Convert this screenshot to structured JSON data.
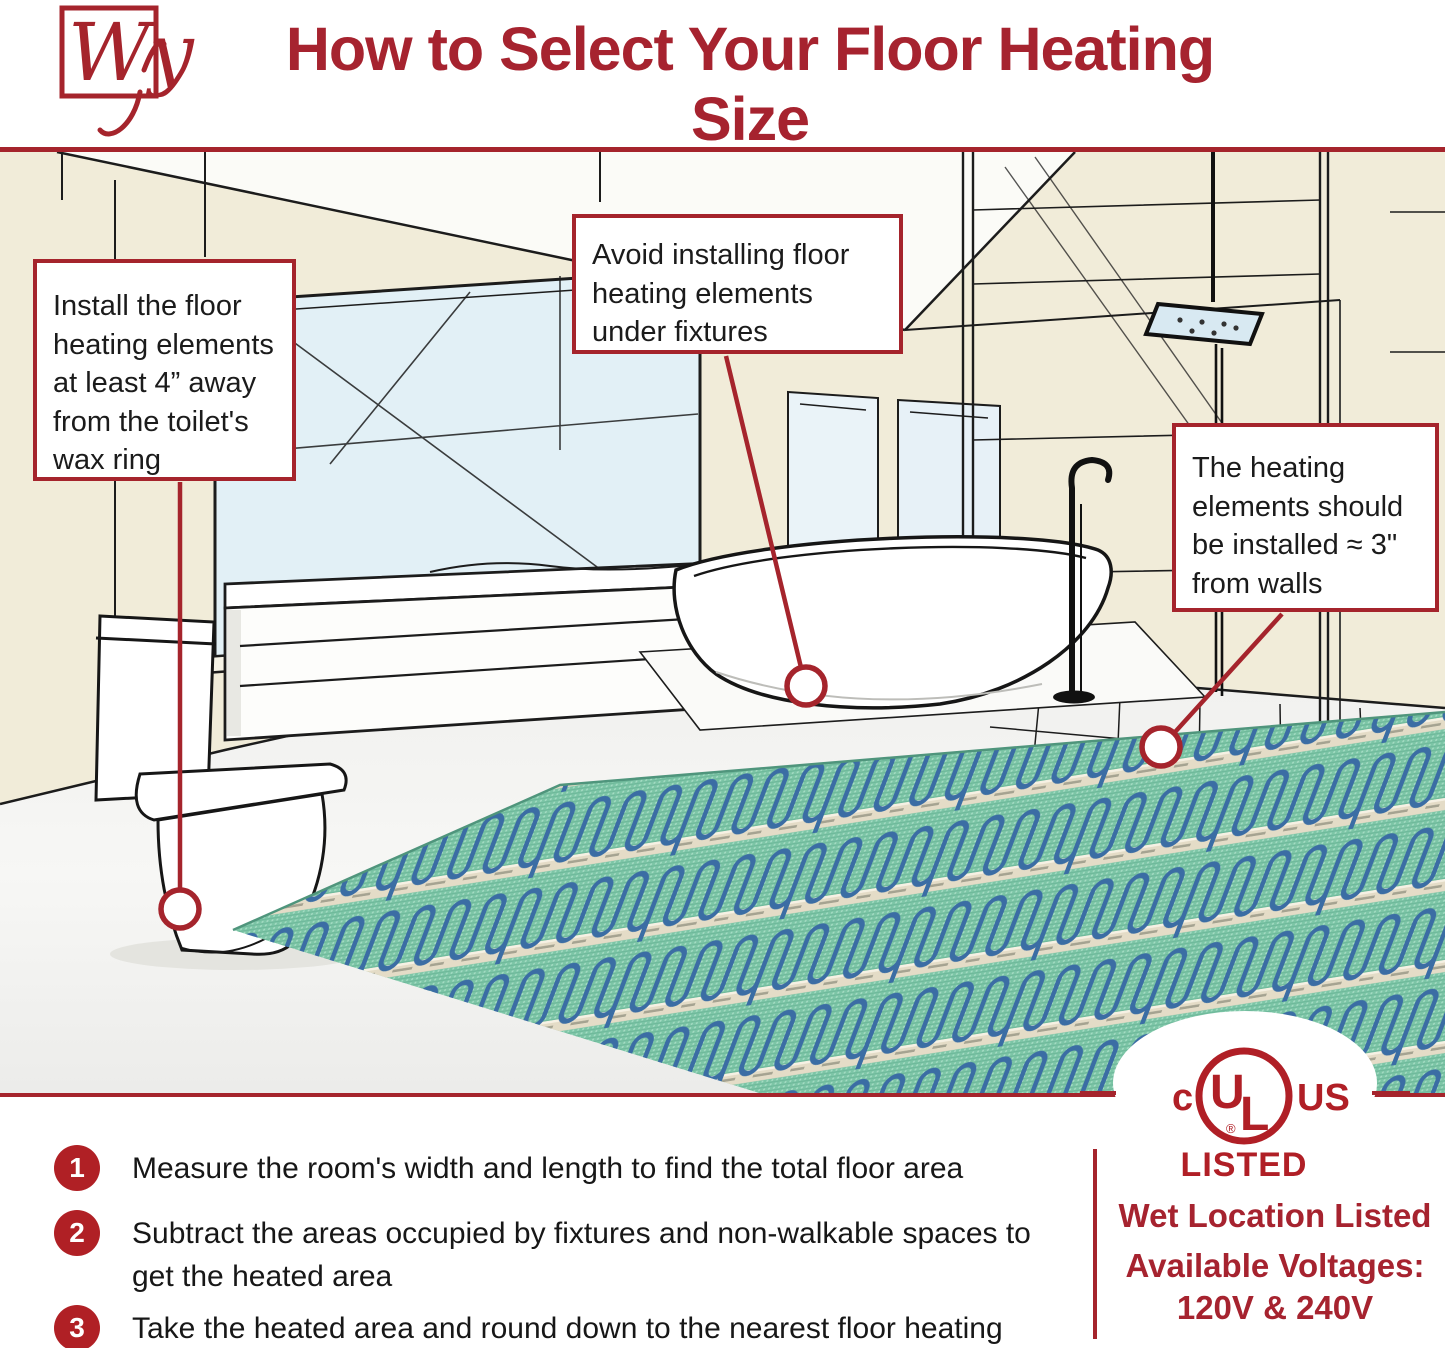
{
  "header": {
    "logo_text": "Wy",
    "title": "How to Select Your Floor Heating Size"
  },
  "callouts": [
    {
      "id": "toilet-clearance",
      "text": "Install the floor heating elements at least 4” away from the toilet's wax ring"
    },
    {
      "id": "avoid-fixtures",
      "text": "Avoid installing floor heating elements under fixtures"
    },
    {
      "id": "wall-clearance",
      "text": "The heating elements should be installed ≈ 3\" from walls"
    }
  ],
  "steps": [
    {
      "number": "1",
      "text": "Measure the room's width and length to find the total floor area"
    },
    {
      "number": "2",
      "text": "Subtract the areas occupied by fixtures and non-walkable spaces to get the heated area"
    },
    {
      "number": "3",
      "text": "Take the heated area and round down to the nearest floor heating size"
    }
  ],
  "certification": {
    "ul_c": "c",
    "ul_mark": "UL",
    "ul_registered": "®",
    "ul_us": "US",
    "listed": "LISTED",
    "wet_location": "Wet Location Listed",
    "voltages_label": "Available Voltages:",
    "voltages_value": "120V & 240V"
  },
  "colors": {
    "accent_red": "#a5242c",
    "badge_red": "#b02025",
    "mat_green": "#7cc5a6",
    "cable_blue": "#3b6da4",
    "wall_cream": "#f1ecd9",
    "window_blue": "#e2f0f6"
  }
}
